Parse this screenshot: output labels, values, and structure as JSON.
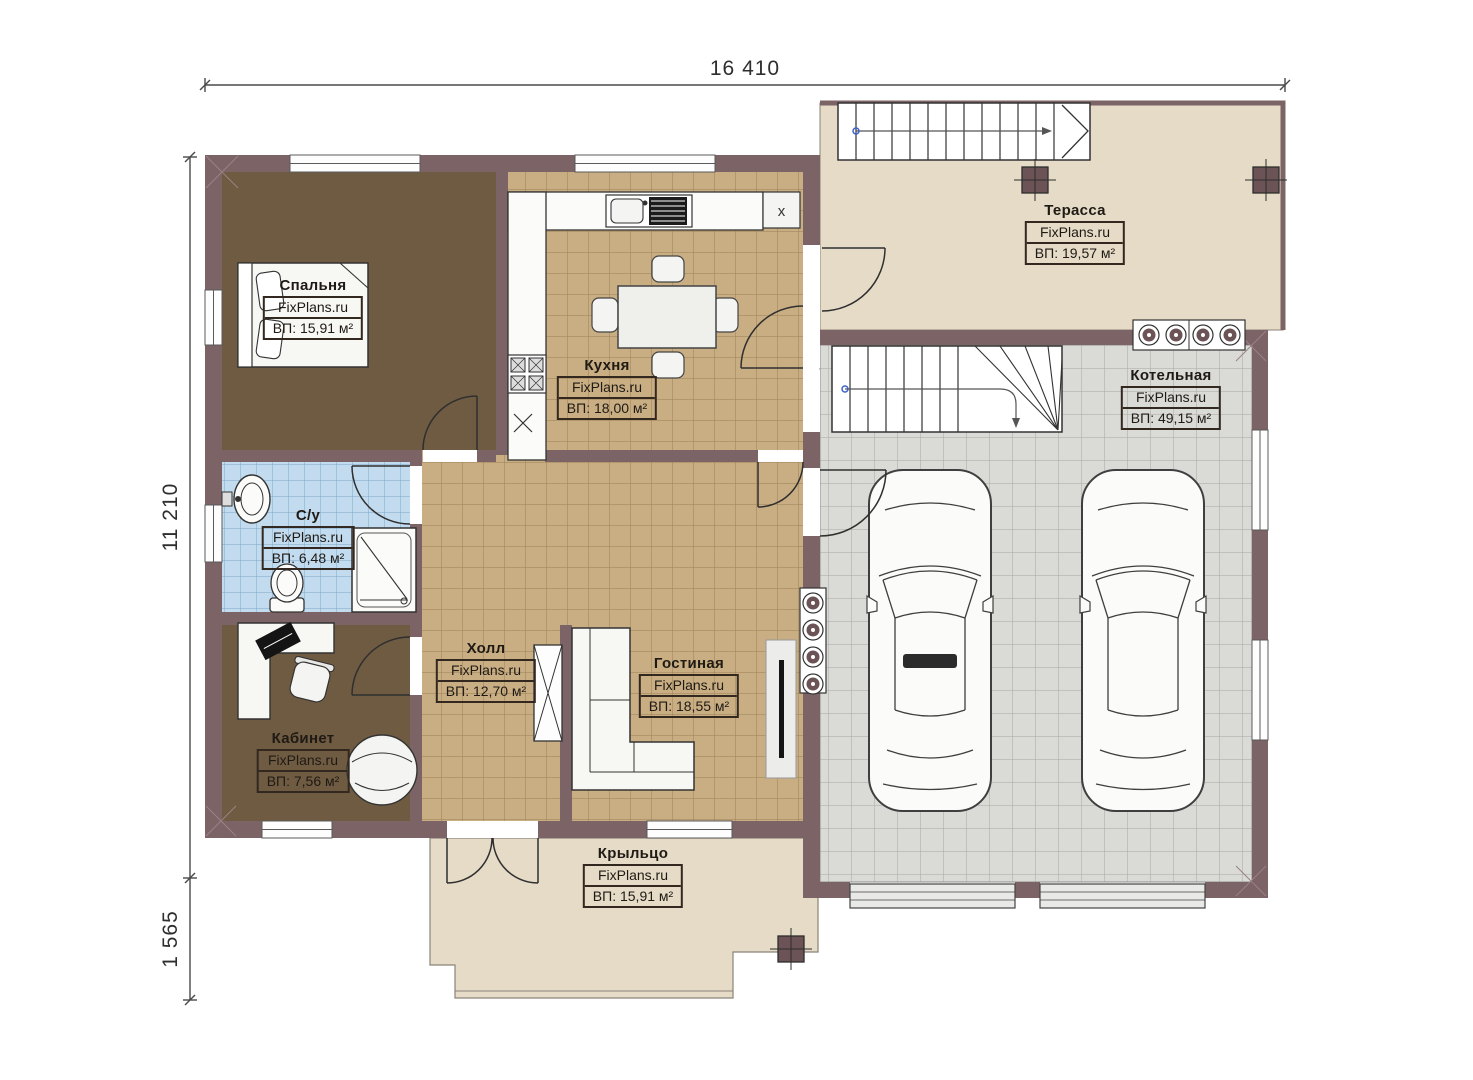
{
  "brand": "FixPlans.ru",
  "dimensions": {
    "total_width_mm": "16 410",
    "main_depth_mm": "11 210",
    "porch_depth_mm": "1 565"
  },
  "rooms": {
    "bedroom": {
      "name": "Спальня",
      "area": "ВП: 15,91 м²"
    },
    "kitchen": {
      "name": "Кухня",
      "area": "ВП: 18,00 м²"
    },
    "terrace": {
      "name": "Терасса",
      "area": "ВП: 19,57 м²"
    },
    "boiler": {
      "name": "Котельная",
      "area": "ВП: 49,15 м²"
    },
    "bathroom": {
      "name": "С/у",
      "area": "ВП: 6,48 м²"
    },
    "office": {
      "name": "Кабинет",
      "area": "ВП: 7,56 м²"
    },
    "hall": {
      "name": "Холл",
      "area": "ВП: 12,70 м²"
    },
    "living": {
      "name": "Гостиная",
      "area": "ВП: 18,55 м²"
    },
    "porch": {
      "name": "Крыльцо",
      "area": "ВП: 15,91 м²"
    }
  },
  "markers": {
    "appliance_x": "x"
  },
  "colors": {
    "wall": "#7c6366",
    "bedroom_floor": "#6f5b42",
    "tile_floor": "#c9ae84",
    "bathroom_floor": "#c3dbee",
    "garage_floor": "#dadad7",
    "terrace_floor": "#e5dbc7",
    "guide_dot_blue": "#3f62c9"
  }
}
